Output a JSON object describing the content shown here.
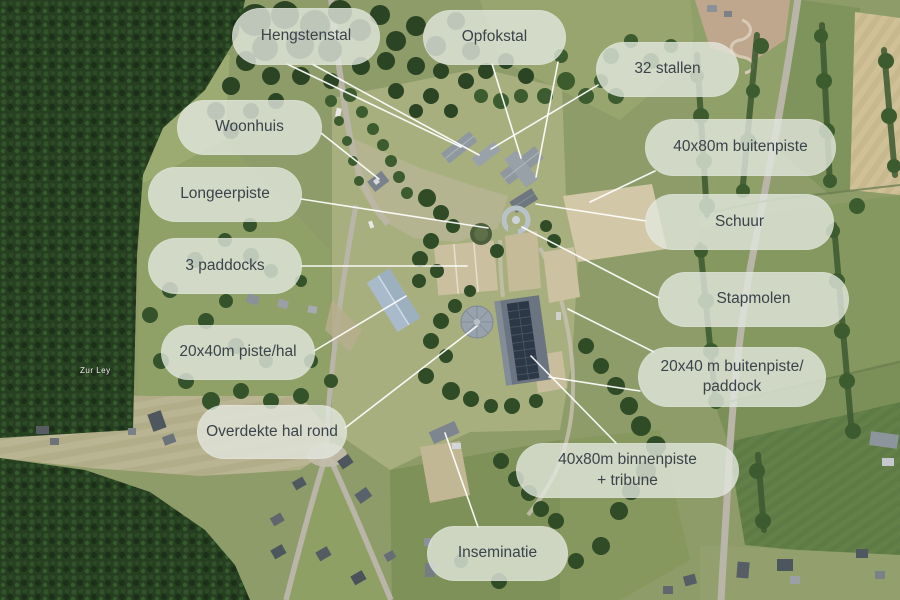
{
  "title": "Equestrian facility aerial overview with labeled features",
  "map": {
    "street_label": "Zur Ley"
  },
  "labels": [
    {
      "id": "hengstenstal",
      "text": "Hengstenstal"
    },
    {
      "id": "opfokstal",
      "text": "Opfokstal"
    },
    {
      "id": "stallen-32",
      "text": "32 stallen"
    },
    {
      "id": "woonhuis",
      "text": "Woonhuis"
    },
    {
      "id": "buitenpiste-40x80",
      "text": "40x80m buitenpiste"
    },
    {
      "id": "longeerpiste",
      "text": "Longeerpiste"
    },
    {
      "id": "schuur",
      "text": "Schuur"
    },
    {
      "id": "paddocks-3",
      "text": "3 paddocks"
    },
    {
      "id": "stapmolen",
      "text": "Stapmolen"
    },
    {
      "id": "piste-hal-20x40",
      "text": "20x40m piste/hal"
    },
    {
      "id": "buitenpiste-20x40",
      "line1": "20x40 m buitenpiste/",
      "line2": "paddock"
    },
    {
      "id": "overdekte-hal",
      "text": "Overdekte hal rond"
    },
    {
      "id": "binnenpiste-40x80",
      "line1": "40x80m binnenpiste",
      "line2": "+ tribune"
    },
    {
      "id": "inseminatie",
      "text": "Inseminatie"
    }
  ],
  "colors": {
    "pill_background": "rgba(226,231,221,0.8)",
    "pill_text": "#3b434b",
    "leader_line": "#ffffff"
  }
}
